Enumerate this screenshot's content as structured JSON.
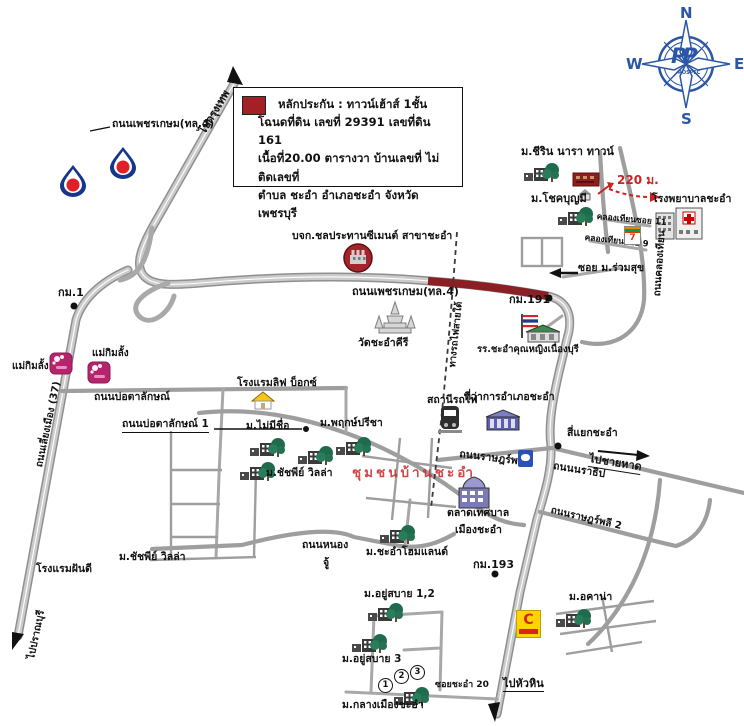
{
  "compass": {
    "north": "N",
    "east": "E",
    "south": "S",
    "west": "W",
    "logo": "PP",
    "logo_text": "ROSPEC"
  },
  "legend": {
    "title_line": "หลักประกัน : ทาวน์เฮ้าส์ 1ชั้น",
    "deed_line": "โฉนดที่ดิน เลขที่ 29391 เลขที่ดิน 161",
    "area_line": "เนื้อที่20.00 ตารางวา บ้านเลขที่ ไม่ติดเลขที่",
    "address_line": "ตำบล ชะอำ อำเภอชะอำ จังหวัดเพชรบุรี"
  },
  "directions": {
    "to_bangkok": "ไปกรุงเทพ",
    "to_pranburi": "ไปปราณบุรี",
    "to_beach": "ไปชายหาด",
    "to_huahin": "ไปหัวหิน"
  },
  "roads": {
    "phetkasem_callout": "ถนนเพชรเกษม(ทล.4)",
    "phetkasem_center": "ถนนเพชรเกษม(ทล.4)",
    "bypass": "ถนนเลี่ยงเมือง (37)",
    "botalak": "ถนนบ่อตาลักษณ์",
    "botalak1": "ถนนบ่อตาลักษณ์ 1",
    "klongtien": "ถนนคลองเทียน",
    "klongtien_soi11": "คลองเทียนซอย 11",
    "klongtien_soi9": "คลองเทียนซอย 9",
    "soi_ruamsuk": "ซอย ม.ร่วมสุข",
    "railway": "ทางรถไฟสายใต้",
    "ratplee": "ถนนราษฎร์พลี",
    "naratip": "ถนนนราธิป",
    "ratplee2": "ถนนราษฎร์พลี 2",
    "nong_line1": "ถนนหนอง",
    "nong_line2": "จู้",
    "soi_chaam20": "ซอยชะอำ 20",
    "chaam_intersection": "สี่แยกชะอำ"
  },
  "markers": {
    "km1": "กม.1",
    "km191": "กม.191",
    "km193": "กม.193",
    "distance": "220 ม."
  },
  "landmarks": {
    "cement": "บจก.ชลประทานซีเมนต์ สาขาชะอำ",
    "wat": "วัดชะอำคีรี",
    "chirin": "ม.ชีริน นารา ทาวน์",
    "chokboonmee": "ม.โชคบุญมี",
    "hospital": "โรงพยาบาลชะอำ",
    "school": "รร.ชะอำคุณหญิงเนื่องบุรี",
    "station": "สถานีรถไฟ",
    "district_office": "ที่ว่าการอำเภอชะอำ",
    "market_line1": "ตลาดเทศบาล",
    "market_line2": "เมืองชะอำ",
    "maekimlang1": "แม่กิมลั้ง",
    "maekimlang2": "แม่กิมลั้ง",
    "hotel_livebox": "โรงแรมลิฟ บ็อกซ์",
    "mai_mee_chue": "ม.ไม่มีชื่อ",
    "pruek_preecha": "ม.พฤกษ์ปรีชา",
    "chatchapee_villa": "ม.ชัชพีย์ วิลล่า",
    "chatchapee_villa2": "ม.ชัชพีย์ วิลล่า",
    "baan_chaam_community": "ชุมชนบ้านชะอำ",
    "homeland": "ม.ชะอำโฮมแลนด์",
    "fandee_hotel": "โรงแรมฝันดี",
    "yoosabai12": "ม.อยู่สบาย 1,2",
    "yoosabai3": "ม.อยู่สบาย 3",
    "klangmuang": "ม.กลางเมืองชะอำ",
    "acana": "ม.อคาน่า",
    "seven_eleven": "7",
    "cmart": "C"
  },
  "badges": {
    "b1": "1",
    "b2": "2",
    "b3": "3"
  },
  "colors": {
    "road": "#9e9e9e",
    "highlight_segment": "#8b2024",
    "accent_red": "#cc2222",
    "compass_blue": "#2a56a5",
    "legend_swatch": "#a32026",
    "community_red": "#c84040",
    "ptt_blue": "#16368c",
    "ptt_red": "#e02028",
    "shop_pink": "#b5256e"
  }
}
